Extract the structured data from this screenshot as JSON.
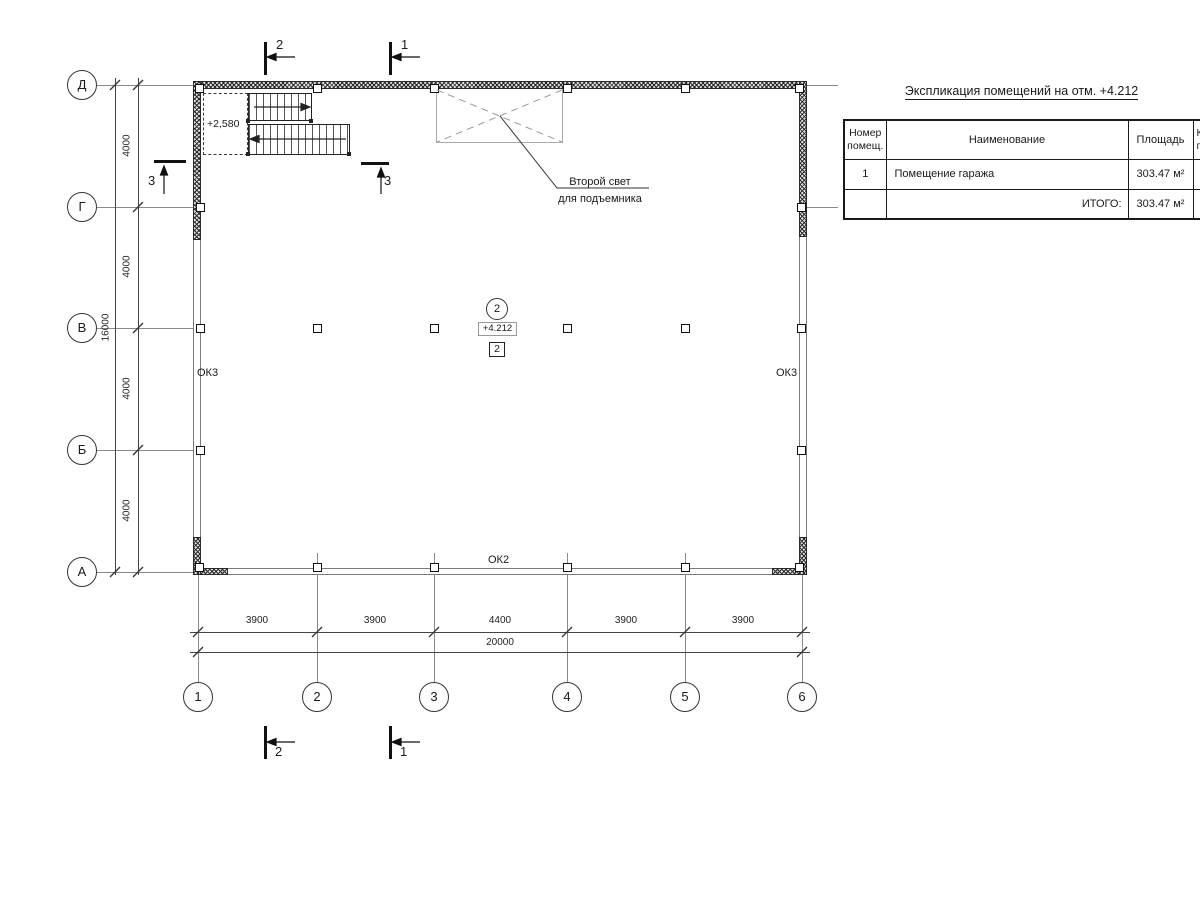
{
  "schedule": {
    "title": "Экспликация помещений на отм. +4.212",
    "headers": {
      "num": "Номер\nпомещ.",
      "name": "Наименование",
      "area": "Площадь",
      "cut": "К\nп"
    },
    "rows": [
      {
        "num": "1",
        "name": "Помещение гаража",
        "area": "303.47 м²"
      }
    ],
    "total_label": "ИТОГО:",
    "total_value": "303.47 м²"
  },
  "grid": {
    "rows": [
      "Д",
      "Г",
      "В",
      "Б",
      "А"
    ],
    "cols": [
      "1",
      "2",
      "3",
      "4",
      "5",
      "6"
    ]
  },
  "dims": {
    "v_segments": [
      "4000",
      "4000",
      "4000",
      "4000"
    ],
    "v_total": "16000",
    "h_segments": [
      "3900",
      "3900",
      "4400",
      "3900",
      "3900"
    ],
    "h_total": "20000"
  },
  "sections": {
    "s1": "1",
    "s2": "2",
    "s3": "3"
  },
  "windows": {
    "left": "ОК3",
    "right": "ОК3",
    "bottom": "ОК2"
  },
  "stairs": {
    "elevation": "+2,580"
  },
  "notes": {
    "position": "2",
    "elevation": "+4.212",
    "node": "2",
    "void_line1": "Второй свет",
    "void_line2": "для подъемника"
  }
}
